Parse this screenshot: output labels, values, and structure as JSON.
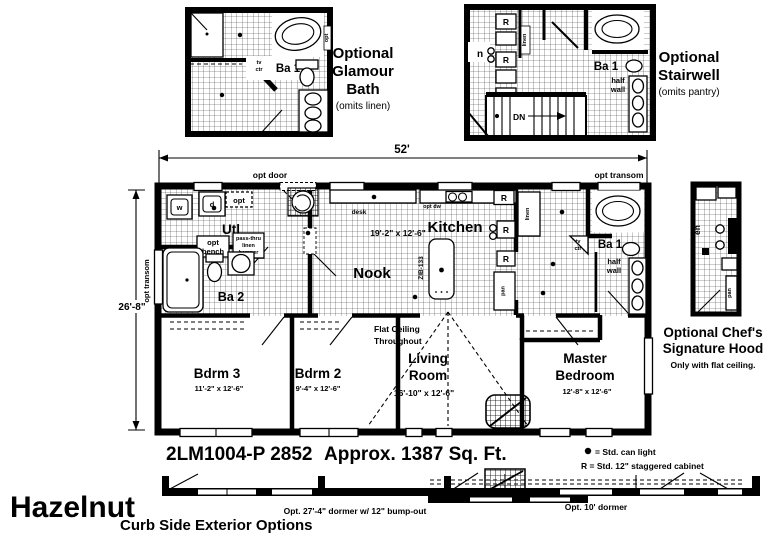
{
  "insets": {
    "glamour_bath": {
      "title1": "Optional",
      "title2": "Glamour",
      "title3": "Bath",
      "subtitle": "(omits linen)",
      "room": "Ba 1",
      "tv": "tv",
      "ctr": "ctr",
      "opt": "opt"
    },
    "stairwell": {
      "title1": "Optional",
      "title2": "Stairwell",
      "subtitle": "(omits pantry)",
      "room": "Ba 1",
      "half": "half",
      "wall": "wall",
      "dn": "DN",
      "r": "R",
      "linen": "linen",
      "kitchen_partial": "n"
    },
    "chefs_hood": {
      "title1": "Optional Chef's",
      "title2": "Signature Hood",
      "subtitle": "Only with flat ceiling.",
      "kitchen_partial": "en",
      "pan": "pan"
    }
  },
  "plan": {
    "dim_width": "52'",
    "dim_height": "26'-8\"",
    "opt_door": "opt door",
    "opt_transom_top": "opt transom",
    "opt_transom_left": "opt transom",
    "utl": "Utl",
    "opt_bench1": "opt",
    "opt_bench2": "bench",
    "passthru1": "pass-thru",
    "passthru2": "linen",
    "passthru3": "hamper",
    "ba2": "Ba 2",
    "nook": "Nook",
    "nook_dim": "19'-2\" x 12'-6\"",
    "kitchen": "Kitchen",
    "island_model": "ZIB-133",
    "desk": "desk",
    "opt_dw": "opt dw",
    "opt_box": "opt",
    "washer": "w",
    "dryer": "d",
    "r": "R",
    "pan": "pan",
    "linen_closet": "linen",
    "tv": "tv",
    "ctr": "ctr",
    "ba1": "Ba 1",
    "half": "half",
    "wall": "wall",
    "flat1": "Flat Ceiling",
    "flat2": "Throughout",
    "living1": "Living",
    "living2": "Room",
    "living_dim": "16'-10\" x 12'-6\"",
    "bdrm3": "Bdrm 3",
    "bdrm3_dim": "11'-2\" x 12'-6\"",
    "bdrm2": "Bdrm 2",
    "bdrm2_dim": "9'-4\" x 12'-6\"",
    "master1": "Master",
    "master2": "Bedroom",
    "master_dim": "12'-8\" x 12'-6\""
  },
  "footer": {
    "model_number": "2LM1004-P 2852",
    "sqft": "Approx. 1387 Sq. Ft.",
    "legend_light": "= Std. can light",
    "legend_cabinet": "R = Std. 12\" staggered cabinet",
    "brand": "Hazelnut",
    "curb_title": "Curb Side Exterior Options",
    "dormer_27": "Opt. 27'-4\" dormer w/ 12\" bump-out",
    "dormer_10": "Opt. 10' dormer"
  }
}
